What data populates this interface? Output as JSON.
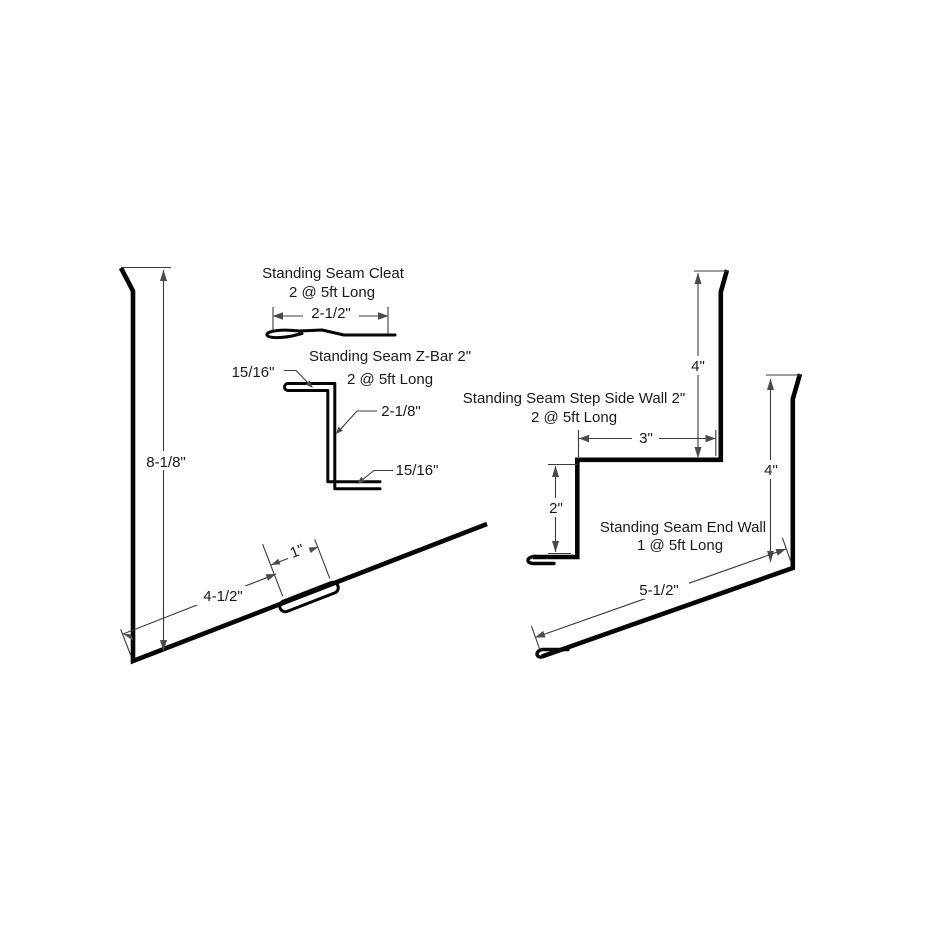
{
  "page": {
    "type": "technical-flashing-profile-drawing",
    "background": "#ffffff"
  },
  "colors": {
    "profile_line": "#050505",
    "dimension_line": "#3b3b3b",
    "arrowhead": "#4a4a4a",
    "label_text": "#1a1a1a"
  },
  "figures": {
    "side_wall": {
      "height": "8-1/8\"",
      "base": "4-1/2\"",
      "hem": "1\""
    },
    "cleat": {
      "title": "Standing Seam Cleat",
      "quantity": "2 @ 5ft Long",
      "width": "2-1/2\""
    },
    "z_bar": {
      "title": "Standing Seam Z-Bar 2\"",
      "quantity": "2 @ 5ft Long",
      "top_leg": "15/16\"",
      "web": "2-1/8\"",
      "bottom_leg": "15/16\""
    },
    "step_side_wall": {
      "title": "Standing Seam Step Side Wall 2\"",
      "quantity": "2 @ 5ft Long",
      "top_height": "4\"",
      "step_run": "3\"",
      "step_drop": "2\""
    },
    "end_wall": {
      "title": "Standing Seam End Wall",
      "quantity": "1 @ 5ft Long",
      "wall_height": "4\"",
      "roof_leg": "5-1/2\""
    }
  }
}
